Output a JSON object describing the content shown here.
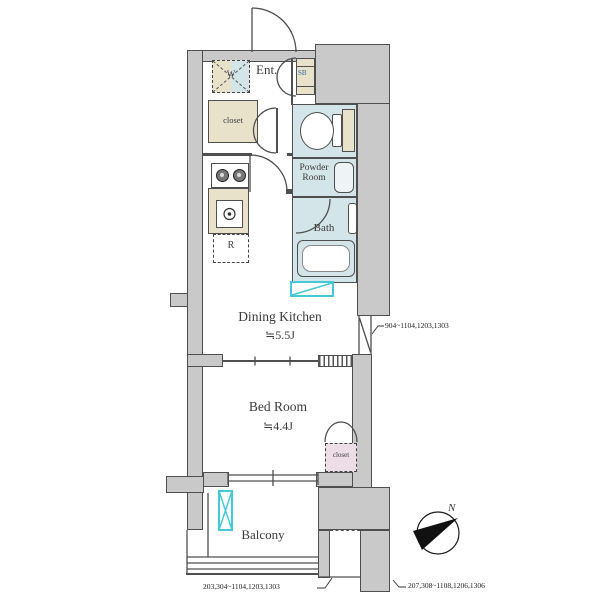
{
  "title": "apartment-floor-plan",
  "labels": {
    "entrance": "Ent.",
    "shoe_box": "SB",
    "hall_closet": "closet",
    "washer": "W",
    "refrigerator": "R",
    "powder_room": "Powder Room",
    "bath": "Bath",
    "dining_kitchen": "Dining Kitchen",
    "dining_kitchen_size": "≒5.5J",
    "bed_room": "Bed Room",
    "bed_room_size": "≒4.4J",
    "bed_closet": "closet",
    "balcony": "Balcony",
    "north": "N"
  },
  "callouts": {
    "window_right_units": "904~1104,1203,1303",
    "bottom_left_units": "203,304~1104,1203,1303",
    "bottom_right_units": "207,308~1108,1206,1306"
  },
  "colors": {
    "wall_fill": "#c9c9c9",
    "wall_outline": "#4f4f4f",
    "wet_room_blue": "#d3e5e9",
    "fixture_beige": "#e9e2ca",
    "closet_pink": "#ecdde6",
    "accent_cyan": "#45c8d8"
  }
}
